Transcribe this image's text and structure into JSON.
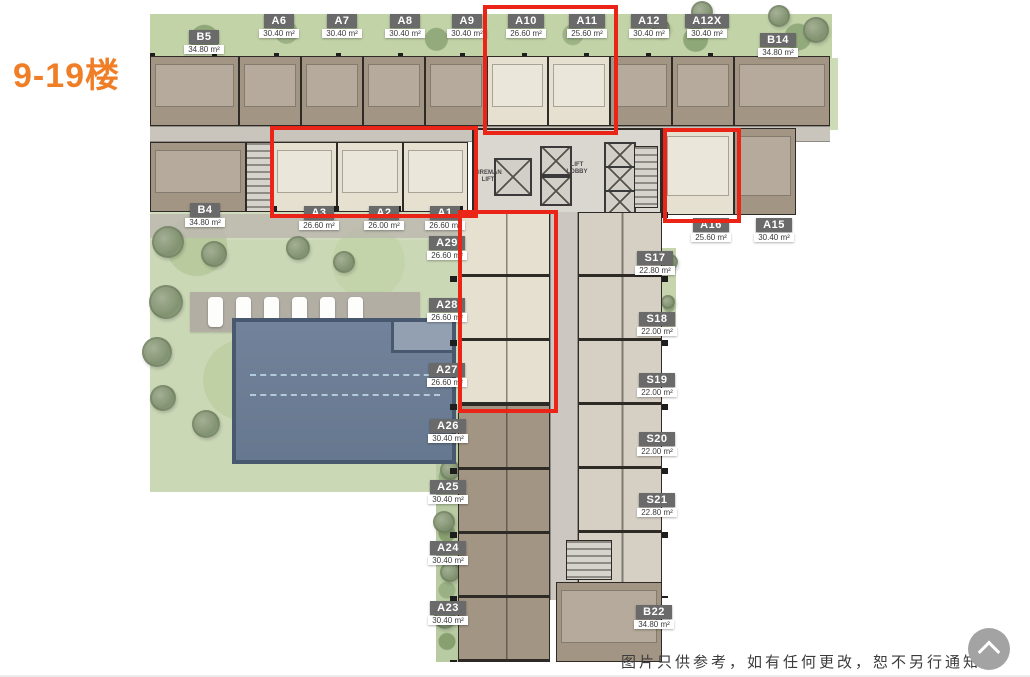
{
  "title": "9-19楼",
  "disclaimer": "图片只供参考，如有任何更改，恕不另行通知",
  "back_to_top": {
    "icon": "chevron-up"
  },
  "core": {
    "lift_lobby": "LIFT\nLOBBY",
    "fireman_lift": "FIREMAN\nLIFT"
  },
  "colors": {
    "accent_orange": "#F07E27",
    "highlight_red": "#EA2517",
    "unit_brown": "#A39583",
    "unit_cream": "#E6E0D1",
    "studio_beige": "#D6D0C4",
    "pool_blue": "#6F7F96",
    "landscape_green": "#C2D3A8"
  },
  "units": [
    {
      "name": "B5",
      "area": "34.80 m²",
      "x": 175,
      "y": 30
    },
    {
      "name": "A6",
      "area": "30.40 m²",
      "x": 250,
      "y": 14
    },
    {
      "name": "A7",
      "area": "30.40 m²",
      "x": 313,
      "y": 14
    },
    {
      "name": "A8",
      "area": "30.40 m²",
      "x": 376,
      "y": 14
    },
    {
      "name": "A9",
      "area": "30.40 m²",
      "x": 438,
      "y": 14
    },
    {
      "name": "A10",
      "area": "26.60 m²",
      "x": 497,
      "y": 14
    },
    {
      "name": "A11",
      "area": "25.60 m²",
      "x": 558,
      "y": 14
    },
    {
      "name": "A12",
      "area": "30.40 m²",
      "x": 620,
      "y": 14
    },
    {
      "name": "A12X",
      "area": "30.40 m²",
      "x": 678,
      "y": 14
    },
    {
      "name": "B14",
      "area": "34.80 m²",
      "x": 749,
      "y": 33
    },
    {
      "name": "B4",
      "area": "34.80 m²",
      "x": 176,
      "y": 203
    },
    {
      "name": "A3",
      "area": "26.60 m²",
      "x": 290,
      "y": 206
    },
    {
      "name": "A2",
      "area": "26.00 m²",
      "x": 355,
      "y": 206
    },
    {
      "name": "A1",
      "area": "26.60 m²",
      "x": 416,
      "y": 206
    },
    {
      "name": "A29",
      "area": "26.60 m²",
      "x": 418,
      "y": 236
    },
    {
      "name": "A28",
      "area": "26.60 m²",
      "x": 418,
      "y": 298
    },
    {
      "name": "A27",
      "area": "26.60 m²",
      "x": 418,
      "y": 363
    },
    {
      "name": "A26",
      "area": "30.40 m²",
      "x": 419,
      "y": 419
    },
    {
      "name": "A25",
      "area": "30.40 m²",
      "x": 419,
      "y": 480
    },
    {
      "name": "A24",
      "area": "30.40 m²",
      "x": 419,
      "y": 541
    },
    {
      "name": "A23",
      "area": "30.40 m²",
      "x": 419,
      "y": 601
    },
    {
      "name": "A16",
      "area": "25.60 m²",
      "x": 682,
      "y": 218
    },
    {
      "name": "A15",
      "area": "30.40 m²",
      "x": 745,
      "y": 218
    },
    {
      "name": "S17",
      "area": "22.80 m²",
      "x": 626,
      "y": 251
    },
    {
      "name": "S18",
      "area": "22.00 m²",
      "x": 628,
      "y": 312
    },
    {
      "name": "S19",
      "area": "22.00 m²",
      "x": 628,
      "y": 373
    },
    {
      "name": "S20",
      "area": "22.00 m²",
      "x": 628,
      "y": 432
    },
    {
      "name": "S21",
      "area": "22.80 m²",
      "x": 628,
      "y": 493
    },
    {
      "name": "B22",
      "area": "34.80 m²",
      "x": 625,
      "y": 605
    }
  ],
  "highlights": [
    {
      "x": 483,
      "y": 5,
      "w": 127,
      "h": 122
    },
    {
      "x": 270,
      "y": 126,
      "w": 200,
      "h": 84
    },
    {
      "x": 663,
      "y": 128,
      "w": 70,
      "h": 87
    },
    {
      "x": 458,
      "y": 210,
      "w": 92,
      "h": 195
    }
  ]
}
